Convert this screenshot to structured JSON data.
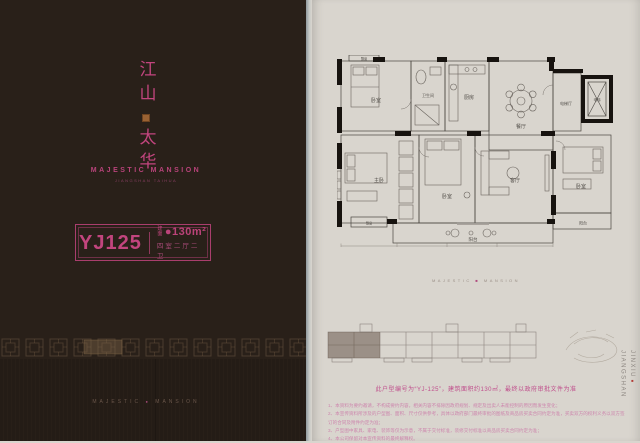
{
  "colors": {
    "accent_pink": "#c2457e",
    "cover_bg": "#292019",
    "page_bg": "#d9d5ce",
    "seal_gold": "#9a6233",
    "wall_black": "#17130f"
  },
  "cover": {
    "title_top": "江山",
    "title_bottom": "太华",
    "subtitle": "MAJESTIC MANSION",
    "subtitle_small": "JIANGSHAN TAIHUA",
    "unit_code": "YJ125",
    "area_label": "建面",
    "area_value": "●130m²",
    "layout": "四室二厅二卫",
    "footer_left": "MAJESTIC",
    "footer_dot": "●",
    "footer_right": "MANSION"
  },
  "plan": {
    "labels": {
      "bay1": "飘窗",
      "bed1": "卧室",
      "bath": "卫生间",
      "kitchen": "厨房",
      "dining": "餐厅",
      "elev_hall": "电梯厅",
      "elevator": "电梯",
      "master": "主卧",
      "bed2": "卧室",
      "living": "客厅",
      "bed3": "卧室",
      "balcony_main": "阳台",
      "balcony_side": "阳台",
      "bay2": "飘窗"
    }
  },
  "page": {
    "watermark_left": "MAJESTIC",
    "watermark_dot": "■",
    "watermark_right": "MANSION",
    "caption": "此户型编号为“YJ-125”，建筑面积约130㎡，最终以政府审批文件为准",
    "disclaimers": [
      "1、本资料为要约邀请，不构成要约内容，相关内容不排除因政府规划、规定及出卖人未能控制的原因而发生变化；",
      "2、本宣传资料所涉及的户型图、面积、尺寸仅供参考，具体以政府部门最终审批的图纸及商品房买卖合同约定为准，买卖双方的权利义务以双方签订的合同及附件约定为准；",
      "3、户型图中家具、家电、装饰等仅为示意，不属于交付标准，装修交付标准以商品房买卖合同约定为准；",
      "4、本公司保留对本宣传资料的最终解释权。"
    ],
    "side_line1": "JINXIU",
    "side_mark": "■",
    "side_line2": "JIANGSHAN"
  }
}
